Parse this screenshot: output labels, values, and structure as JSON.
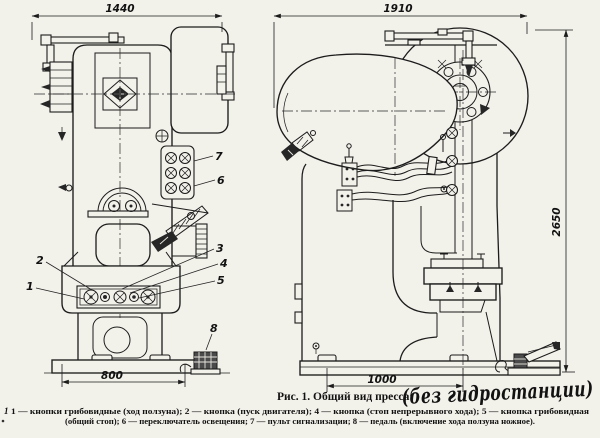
{
  "figure": {
    "caption": "Рис. 1. Общий вид пресса:",
    "caption_handwritten": "(без гидростанции)",
    "legend_line1": "1 — кнопки грибовидные (ход ползуна); 2 — кнопка (пуск двигателя); 4 — кнопка (стоп непрерывного хода); 5 — кнопка грибовидная",
    "legend_line2": "(общий стоп); 6 — переключатель освещения; 7 — пульт сигнализации; 8 — педаль (включение хода ползуна ножное).",
    "margin_mark": "1"
  },
  "dimensions": {
    "front_overall_width": "1440",
    "side_overall_width": "1910",
    "overall_height": "2650",
    "front_base_width": "800",
    "side_base_width": "1000"
  },
  "callouts": {
    "slide_buttons": "1",
    "motor_start_button": "2",
    "button_3": "3",
    "stop_button": "4",
    "mushroom_stop_button": "5",
    "light_switch": "6",
    "signal_console": "7",
    "foot_pedal": "8"
  }
}
